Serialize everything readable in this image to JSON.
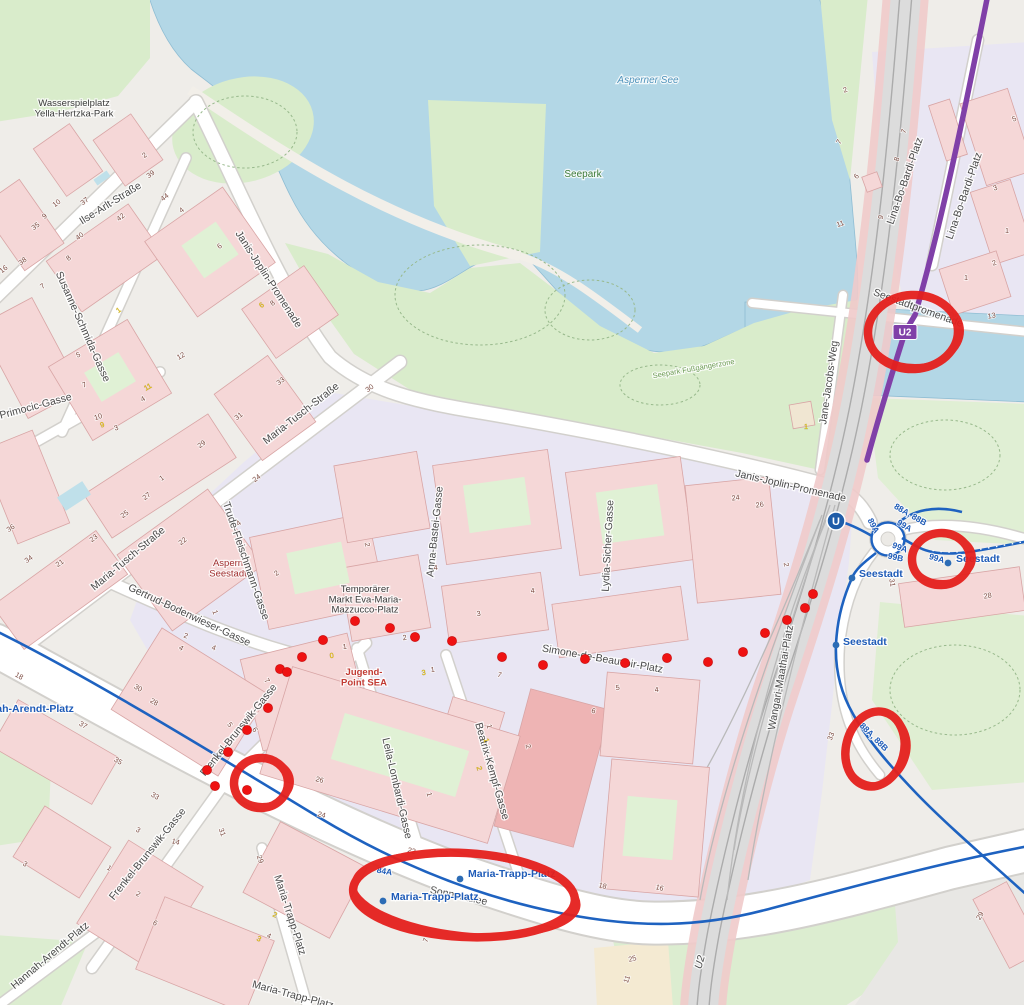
{
  "canvas": {
    "width": 1024,
    "height": 1005
  },
  "colors": {
    "water": "#b3d7e6",
    "park": "#d9eccb",
    "park_light": "#e4f1da",
    "building": "#f5d7d7",
    "building_dark": "#eeb4b4",
    "building_outline": "#d8a5a5",
    "pedestrian": "#e9e6f3",
    "road": "#ffffff",
    "road_casing": "#d2d0cc",
    "railway": "#dcdcdc",
    "railway_flank": "#f0caca",
    "u2_purple": "#8040a8",
    "bus_blue": "#1e62c0",
    "stop_blue": "#2c6cb5",
    "annotation_red": "#e5201d",
    "marker_red": "#ef1212"
  },
  "place_labels": [
    {
      "name": "wasserspielplatz-yella-hertzka-park",
      "lines": [
        "Wasserspielplatz",
        "Yella-Hertzka-Park"
      ],
      "x": 74,
      "y": 106,
      "size": 9.5,
      "color": "#3a3a3a"
    },
    {
      "name": "asperner-see",
      "lines": [
        "Asperner See"
      ],
      "x": 648,
      "y": 83,
      "size": 10,
      "color": "#4f93bb",
      "italic": true
    },
    {
      "name": "seepark",
      "lines": [
        "Seepark"
      ],
      "x": 583,
      "y": 177,
      "size": 10,
      "color": "#3c7a38"
    },
    {
      "name": "seepark-fussgaengerzone",
      "lines": [
        "Seepark Fußgängerzone"
      ],
      "x": 694,
      "y": 371,
      "size": 7.5,
      "color": "#6d9c55",
      "rot": -10
    },
    {
      "name": "aspern-seestadt",
      "lines": [
        "Aspern",
        "Seestadt"
      ],
      "x": 228,
      "y": 566,
      "size": 9.5,
      "color": "#a02f2f"
    },
    {
      "name": "temporaerer-markt-eva-maria-mazzucco-platz",
      "lines": [
        "Temporärer",
        "Markt Eva-Maria-",
        "Mazzucco-Platz"
      ],
      "x": 365,
      "y": 592,
      "size": 9.5,
      "color": "#3a3a3a"
    },
    {
      "name": "jugend-point-sea",
      "lines": [
        "Jugend-",
        "Point SEA"
      ],
      "x": 364,
      "y": 675,
      "size": 9.5,
      "color": "#c23b33",
      "bold": true
    }
  ],
  "street_labels": [
    {
      "text": "Ilse-Arlt-Straße",
      "x": 112,
      "y": 206,
      "rot": -32
    },
    {
      "text": "Janis-Joplin-Promenade",
      "x": 266,
      "y": 281,
      "rot": 57
    },
    {
      "text": "Janis-Joplin-Promenade",
      "x": 790,
      "y": 489,
      "rot": 13
    },
    {
      "text": "Susanne-Schmida-Gasse",
      "x": 80,
      "y": 328,
      "rot": 66
    },
    {
      "text": "Ans-Primocic-Gasse",
      "x": 26,
      "y": 412,
      "rot": -15
    },
    {
      "text": "Maria-Tusch-Straße",
      "x": 130,
      "y": 561,
      "rot": -40
    },
    {
      "text": "Maria-Tusch-Straße",
      "x": 303,
      "y": 416,
      "rot": -38
    },
    {
      "text": "Trude-Fleischmann-Gasse",
      "x": 243,
      "y": 562,
      "rot": 71
    },
    {
      "text": "Gertrud-Bodenwieser-Gasse",
      "x": 188,
      "y": 618,
      "rot": 25
    },
    {
      "text": "Anna-Bastei-Gasse",
      "x": 438,
      "y": 532,
      "rot": -84
    },
    {
      "text": "Lydia-Sicher-Gasse",
      "x": 611,
      "y": 546,
      "rot": -87
    },
    {
      "text": "Simone-de-Beauvoir-Platz",
      "x": 602,
      "y": 662,
      "rot": 10,
      "size": 12.5
    },
    {
      "text": "Wangari-Maathai-Platz",
      "x": 784,
      "y": 678,
      "rot": -80
    },
    {
      "text": "Jane-Jacobs-Weg",
      "x": 832,
      "y": 383,
      "rot": -82
    },
    {
      "text": "Lina-Bo-Bardi-Platz",
      "x": 908,
      "y": 182,
      "rot": -71
    },
    {
      "text": "Lina-Bo-Bardi-Platz",
      "x": 967,
      "y": 197,
      "rot": -71
    },
    {
      "text": "Seestadtpromenade",
      "x": 917,
      "y": 311,
      "rot": 20,
      "size": 9.5
    },
    {
      "text": "Frenkel-Brunswik-Gasse",
      "x": 241,
      "y": 732,
      "rot": -51
    },
    {
      "text": "Frenkel-Brunswik-Gasse",
      "x": 150,
      "y": 856,
      "rot": -51
    },
    {
      "text": "Leila-Lombardi-Gasse",
      "x": 394,
      "y": 789,
      "rot": 77
    },
    {
      "text": "Beatrix-Kempf-Gasse",
      "x": 489,
      "y": 772,
      "rot": 74
    },
    {
      "text": "Maria-Trapp-Platz",
      "x": 287,
      "y": 916,
      "rot": 72
    },
    {
      "text": "Maria-Trapp-Platz",
      "x": 292,
      "y": 998,
      "rot": 15
    },
    {
      "text": "Sonnenallee",
      "x": 458,
      "y": 899,
      "rot": 12,
      "color": "#6f6f6f",
      "size": 11
    },
    {
      "text": "Hannah-Arendt-Platz",
      "x": 52,
      "y": 958,
      "rot": -40
    },
    {
      "text": "U2",
      "x": 703,
      "y": 963,
      "rot": -74,
      "color": "#7a7a7a",
      "italic": true,
      "size": 10
    }
  ],
  "house_numbers": [
    [
      "39",
      152,
      176,
      -38
    ],
    [
      "2",
      146,
      157,
      -38
    ],
    [
      "10",
      58,
      205,
      -38
    ],
    [
      "37",
      86,
      203,
      -38
    ],
    [
      "35",
      37,
      228,
      -38
    ],
    [
      "9",
      46,
      218,
      -38
    ],
    [
      "42",
      122,
      219,
      -38
    ],
    [
      "44",
      166,
      199,
      -38
    ],
    [
      "40",
      81,
      238,
      -38
    ],
    [
      "4",
      183,
      212,
      -38
    ],
    [
      "8",
      70,
      260,
      -38
    ],
    [
      "6",
      221,
      248,
      -38
    ],
    [
      "16",
      5,
      271,
      -38
    ],
    [
      "38",
      24,
      263,
      -38
    ],
    [
      "7",
      44,
      288,
      -38
    ],
    [
      "6",
      263,
      307,
      -38,
      1
    ],
    [
      "8",
      274,
      305,
      -38
    ],
    [
      "1",
      120,
      312,
      -38,
      1
    ],
    [
      "5",
      79,
      357,
      -20
    ],
    [
      "7",
      85,
      387,
      -20
    ],
    [
      "12",
      182,
      358,
      -30
    ],
    [
      "11",
      149,
      389,
      -30,
      1
    ],
    [
      "4",
      144,
      401,
      -30
    ],
    [
      "10",
      99,
      419,
      -20
    ],
    [
      "9",
      103,
      427,
      -20,
      1
    ],
    [
      "3",
      117,
      430,
      -20
    ],
    [
      "36",
      12,
      530,
      -35
    ],
    [
      "34",
      30,
      561,
      -35
    ],
    [
      "21",
      61,
      565,
      -35
    ],
    [
      "1",
      163,
      480,
      -35
    ],
    [
      "29",
      203,
      446,
      -38
    ],
    [
      "31",
      240,
      418,
      -38
    ],
    [
      "33",
      282,
      383,
      -38
    ],
    [
      "30",
      371,
      390,
      -38
    ],
    [
      "24",
      258,
      480,
      -38
    ],
    [
      "27",
      148,
      498,
      -38
    ],
    [
      "25",
      126,
      516,
      -38
    ],
    [
      "23",
      95,
      540,
      -38
    ],
    [
      "22",
      184,
      543,
      -38
    ],
    [
      "4",
      240,
      525,
      -38
    ],
    [
      "2",
      278,
      575,
      -38
    ],
    [
      "2",
      185,
      638,
      20
    ],
    [
      "4",
      213,
      650,
      20
    ],
    [
      "1",
      213,
      613,
      70
    ],
    [
      "2",
      365,
      545,
      80
    ],
    [
      "2",
      846,
      92,
      -20
    ],
    [
      "7",
      841,
      143,
      -60
    ],
    [
      "8",
      899,
      160,
      -70
    ],
    [
      "6",
      858,
      178,
      -45
    ],
    [
      "7",
      906,
      132,
      -70
    ],
    [
      "9",
      883,
      218,
      -70
    ],
    [
      "11",
      841,
      226,
      -20
    ],
    [
      "5",
      1015,
      121,
      -20
    ],
    [
      "3",
      996,
      190,
      -20
    ],
    [
      "1",
      1007,
      233,
      0
    ],
    [
      "2",
      995,
      265,
      -20
    ],
    [
      "13",
      992,
      318,
      -10
    ],
    [
      "1",
      966,
      280,
      0
    ],
    [
      "24",
      736,
      500,
      -8
    ],
    [
      "26",
      760,
      507,
      -8
    ],
    [
      "2",
      784,
      565,
      80
    ],
    [
      "1",
      806,
      429,
      0,
      1
    ],
    [
      "4",
      436,
      570,
      -8
    ],
    [
      "4",
      533,
      593,
      -8
    ],
    [
      "3",
      479,
      616,
      -8
    ],
    [
      "2",
      405,
      640,
      -8
    ],
    [
      "1",
      433,
      672,
      -8
    ],
    [
      "3",
      424,
      675,
      -8,
      1
    ],
    [
      "0",
      332,
      658,
      -8,
      1
    ],
    [
      "1",
      345,
      649,
      -8
    ],
    [
      "7",
      499,
      677,
      15
    ],
    [
      "6",
      593,
      713,
      15
    ],
    [
      "1",
      427,
      795,
      75
    ],
    [
      "1",
      487,
      727,
      75
    ],
    [
      "1",
      484,
      741,
      75,
      1
    ],
    [
      "2",
      477,
      769,
      75,
      1
    ],
    [
      "2",
      526,
      747,
      75
    ],
    [
      "5",
      618,
      690,
      -8
    ],
    [
      "4",
      657,
      692,
      -8
    ],
    [
      "22",
      411,
      853,
      15
    ],
    [
      "18",
      602,
      888,
      15
    ],
    [
      "16",
      659,
      890,
      15
    ],
    [
      "28",
      153,
      704,
      30
    ],
    [
      "5",
      228,
      726,
      55
    ],
    [
      "6",
      253,
      731,
      55
    ],
    [
      "33",
      154,
      798,
      30
    ],
    [
      "26",
      319,
      782,
      15
    ],
    [
      "24",
      321,
      817,
      15
    ],
    [
      "31",
      220,
      833,
      70
    ],
    [
      "14",
      175,
      844,
      15
    ],
    [
      "18",
      18,
      678,
      30
    ],
    [
      "30",
      137,
      690,
      30
    ],
    [
      "37",
      82,
      727,
      30
    ],
    [
      "35",
      117,
      763,
      30
    ],
    [
      "3",
      137,
      832,
      30
    ],
    [
      "1",
      108,
      870,
      30
    ],
    [
      "3",
      24,
      866,
      30
    ],
    [
      "2",
      137,
      896,
      30
    ],
    [
      "6",
      154,
      925,
      30
    ],
    [
      "4",
      180,
      650,
      30
    ],
    [
      "7",
      265,
      682,
      55
    ],
    [
      "29",
      258,
      860,
      70
    ],
    [
      "2",
      274,
      917,
      25,
      1
    ],
    [
      "3",
      258,
      941,
      25,
      1
    ],
    [
      "4",
      268,
      938,
      25
    ],
    [
      "25",
      633,
      961,
      -15
    ],
    [
      "11",
      629,
      980,
      -70
    ],
    [
      "29",
      982,
      917,
      -60
    ],
    [
      "28",
      988,
      598,
      -10
    ],
    [
      "31",
      890,
      583,
      80
    ],
    [
      "33",
      833,
      737,
      -70
    ],
    [
      "7",
      428,
      941,
      -70
    ]
  ],
  "transit": {
    "u2_badge": {
      "text": "U2",
      "x": 905,
      "y": 332
    },
    "station_logo": {
      "text": "U",
      "x": 836,
      "y": 521
    },
    "route_labels": [
      {
        "text": "88A, 88B",
        "x": 909,
        "y": 517,
        "rot": 30
      },
      {
        "text": "99A",
        "x": 903,
        "y": 528,
        "rot": 30
      },
      {
        "text": "89A",
        "x": 871,
        "y": 527,
        "rot": 62
      },
      {
        "text": "99A",
        "x": 899,
        "y": 550,
        "rot": 20
      },
      {
        "text": "99B",
        "x": 895,
        "y": 560,
        "rot": 12
      },
      {
        "text": "99A",
        "x": 936,
        "y": 561,
        "rot": 16
      },
      {
        "text": "88A, 88B",
        "x": 872,
        "y": 739,
        "rot": 45
      },
      {
        "text": "84A",
        "x": 384,
        "y": 874,
        "rot": 10
      }
    ],
    "stops": [
      {
        "name": "Seestadt",
        "lx": 859,
        "ly": 577,
        "dx": 852,
        "dy": 578
      },
      {
        "name": "Seestadt",
        "lx": 843,
        "ly": 645,
        "dx": 836,
        "dy": 645
      },
      {
        "name": "Seestadt",
        "lx": 956,
        "ly": 562,
        "dx": 948,
        "dy": 563
      },
      {
        "name": "Maria-Trapp-Platz",
        "lx": 468,
        "ly": 877,
        "dx": 460,
        "dy": 879
      },
      {
        "name": "Maria-Trapp-Platz",
        "lx": 391,
        "ly": 900,
        "dx": 383,
        "dy": 901
      },
      {
        "name": "Hannah-Arendt-Platz",
        "lx": -30,
        "ly": 712
      }
    ]
  },
  "annotations": {
    "dots": [
      [
        280,
        669
      ],
      [
        302,
        657
      ],
      [
        323,
        640
      ],
      [
        355,
        621
      ],
      [
        390,
        628
      ],
      [
        415,
        637
      ],
      [
        452,
        641
      ],
      [
        502,
        657
      ],
      [
        543,
        665
      ],
      [
        585,
        659
      ],
      [
        625,
        663
      ],
      [
        667,
        658
      ],
      [
        708,
        662
      ],
      [
        743,
        652
      ],
      [
        765,
        633
      ],
      [
        787,
        620
      ],
      [
        805,
        608
      ],
      [
        813,
        594
      ],
      [
        287,
        672
      ],
      [
        268,
        708
      ],
      [
        247,
        730
      ],
      [
        228,
        752
      ],
      [
        207,
        770
      ],
      [
        215,
        786
      ],
      [
        247,
        790
      ]
    ],
    "circles": [
      {
        "label": "u2-station-seestadtpromenade",
        "cx": 913,
        "cy": 332,
        "rx": 45,
        "ry": 37,
        "rot": -3
      },
      {
        "label": "bus-99a-seestadt-stop",
        "cx": 941,
        "cy": 559,
        "rx": 29,
        "ry": 26,
        "rot": -4
      },
      {
        "label": "bus-88a-88b-route",
        "cx": 875,
        "cy": 749,
        "rx": 29,
        "ry": 38,
        "rot": 14
      },
      {
        "label": "frenkel-brunswik-26",
        "cx": 261,
        "cy": 783,
        "rx": 27,
        "ry": 25,
        "rot": -5
      },
      {
        "label": "maria-trapp-platz-stops",
        "cx": 464,
        "cy": 895,
        "rx": 111,
        "ry": 42,
        "rot": 3
      }
    ]
  }
}
